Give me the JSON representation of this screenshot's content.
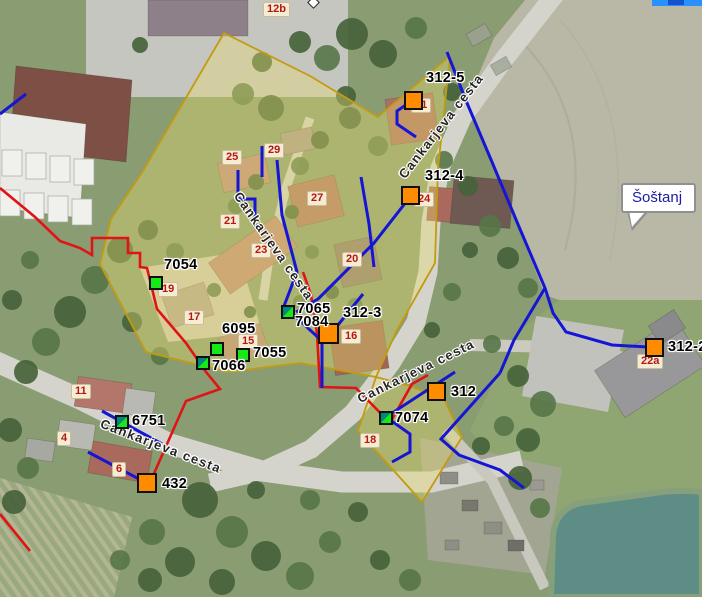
{
  "map": {
    "callout": {
      "text": "Šoštanj"
    },
    "street_labels": [
      "Cankarjeva cesta",
      "Cankarjeva cesta",
      "Cankarjeva cesta",
      "Cankarjeva cesta"
    ],
    "hydrants": [
      {
        "id": "312-5"
      },
      {
        "id": "312-4"
      },
      {
        "id": "312-3"
      },
      {
        "id": "312"
      },
      {
        "id": "312-2"
      },
      {
        "id": "432"
      }
    ],
    "valves": [
      {
        "id": "7054"
      },
      {
        "id": "6095"
      },
      {
        "id": "7055"
      },
      {
        "id": "7066"
      },
      {
        "id": "6751"
      },
      {
        "id": "7065"
      },
      {
        "id": "7084"
      },
      {
        "id": "7074"
      }
    ],
    "house_numbers": [
      "12b",
      "31",
      "25",
      "29",
      "27",
      "21",
      "23",
      "20",
      "24",
      "19",
      "17",
      "15",
      "16",
      "11",
      "4",
      "6",
      "18",
      "22a"
    ],
    "colors": {
      "hydrant": "#ff8c00",
      "valve": "#17e817",
      "valve_accent": "#00897b",
      "water": "#1515d6",
      "secondary": "#e01414",
      "parcel": "#c39b10",
      "parcel_fill": "rgba(232,222,110,0.38)",
      "house_number_text": "#b51616",
      "house_number_bg": "#f5ecd2"
    }
  }
}
